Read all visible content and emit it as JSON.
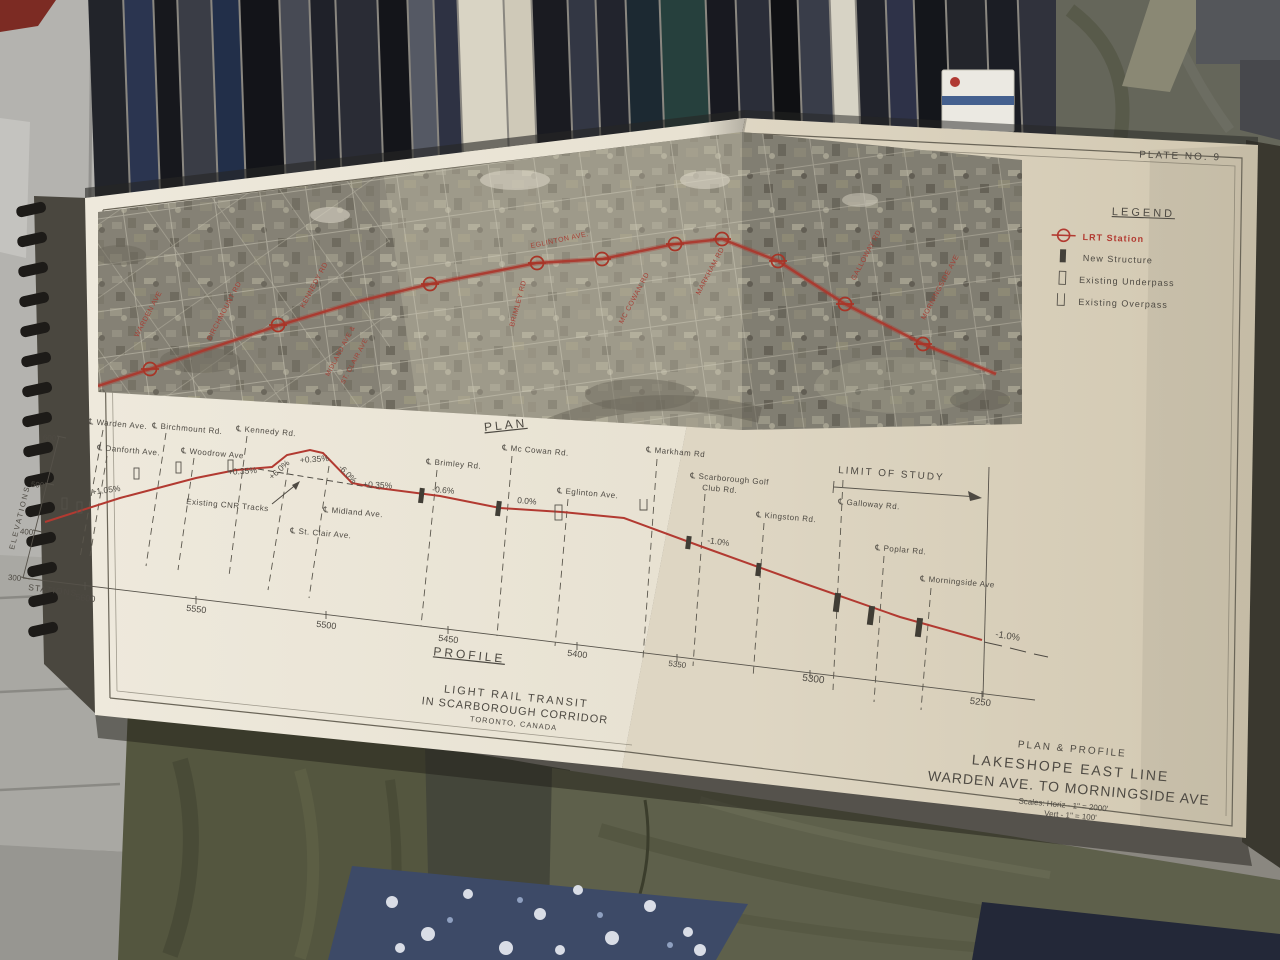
{
  "plate": {
    "label": "PLATE NO. 9"
  },
  "legend": {
    "title": "LEGEND",
    "items": [
      {
        "label": "LRT Station"
      },
      {
        "label": "New Structure"
      },
      {
        "label": "Existing Underpass"
      },
      {
        "label": "Existing Overpass"
      }
    ],
    "station_color": "#b23a31"
  },
  "plan": {
    "label": "PLAN",
    "map_labels": [
      "WARDEN AVE",
      "BIRCHMOUNT RD",
      "KENNEDY RD",
      "MIDLAND AVE &",
      "ST. CLAIR AVE",
      "EGLINTON AVE.",
      "BRIMLEY RD",
      "MC COWAN RD",
      "MARKHAM RD",
      "GALLOWAY RD",
      "MORNINGSIDE AVE"
    ]
  },
  "profile": {
    "label": "PROFILE",
    "elevation_axis": {
      "label": "ELEVATIONS",
      "ticks": [
        "600",
        "500",
        "400",
        "300"
      ]
    },
    "station_axis": {
      "label": "STATIONS",
      "ticks": [
        "5600",
        "5550",
        "5500",
        "5450",
        "5400",
        "5350",
        "5300",
        "5250"
      ]
    },
    "roads": [
      "℄ Warden Ave.",
      "℄ Danforth Ave.",
      "℄ Birchmount Rd.",
      "℄ Woodrow Ave",
      "℄ Kennedy Rd.",
      "℄ St. Clair Ave.",
      "℄ Midland Ave.",
      "℄ Brimley Rd.",
      "℄ Mc Cowan Rd.",
      "℄ Eglinton Ave.",
      "℄ Markham Rd",
      "℄ Scarborough Golf",
      "Club Rd.",
      "℄ Kingston Rd.",
      "℄ Galloway Rd.",
      "℄ Poplar Rd.",
      "℄ Morningside Ave"
    ],
    "grades": [
      "+1.05%",
      "+0.35%",
      "+6.0%",
      "+0.35%",
      "-6.0%",
      "+0.35%",
      "-0.6%",
      "0.0%",
      "-1.0%",
      "-1.0%"
    ],
    "cnr_label": "Existing CNR Tracks",
    "limit_label": "LIMIT OF STUDY"
  },
  "titles": {
    "project_line1": "LIGHT RAIL TRANSIT",
    "project_line2": "IN SCARBOROUGH CORRIDOR",
    "project_line3": "TORONTO, CANADA",
    "sheet_line1": "PLAN & PROFILE",
    "sheet_line2": "LAKESHOPE EAST LINE",
    "sheet_line3": "WARDEN AVE. TO MORNINGSIDE AVE",
    "scales_line1": "Scales: Horiz - 1\" = 2000'",
    "scales_line2": "Vert - 1\" = 100'"
  },
  "colors": {
    "drawing_red": "#b23a31",
    "paper": "#e9e4d4",
    "ink": "#4e4a43"
  }
}
